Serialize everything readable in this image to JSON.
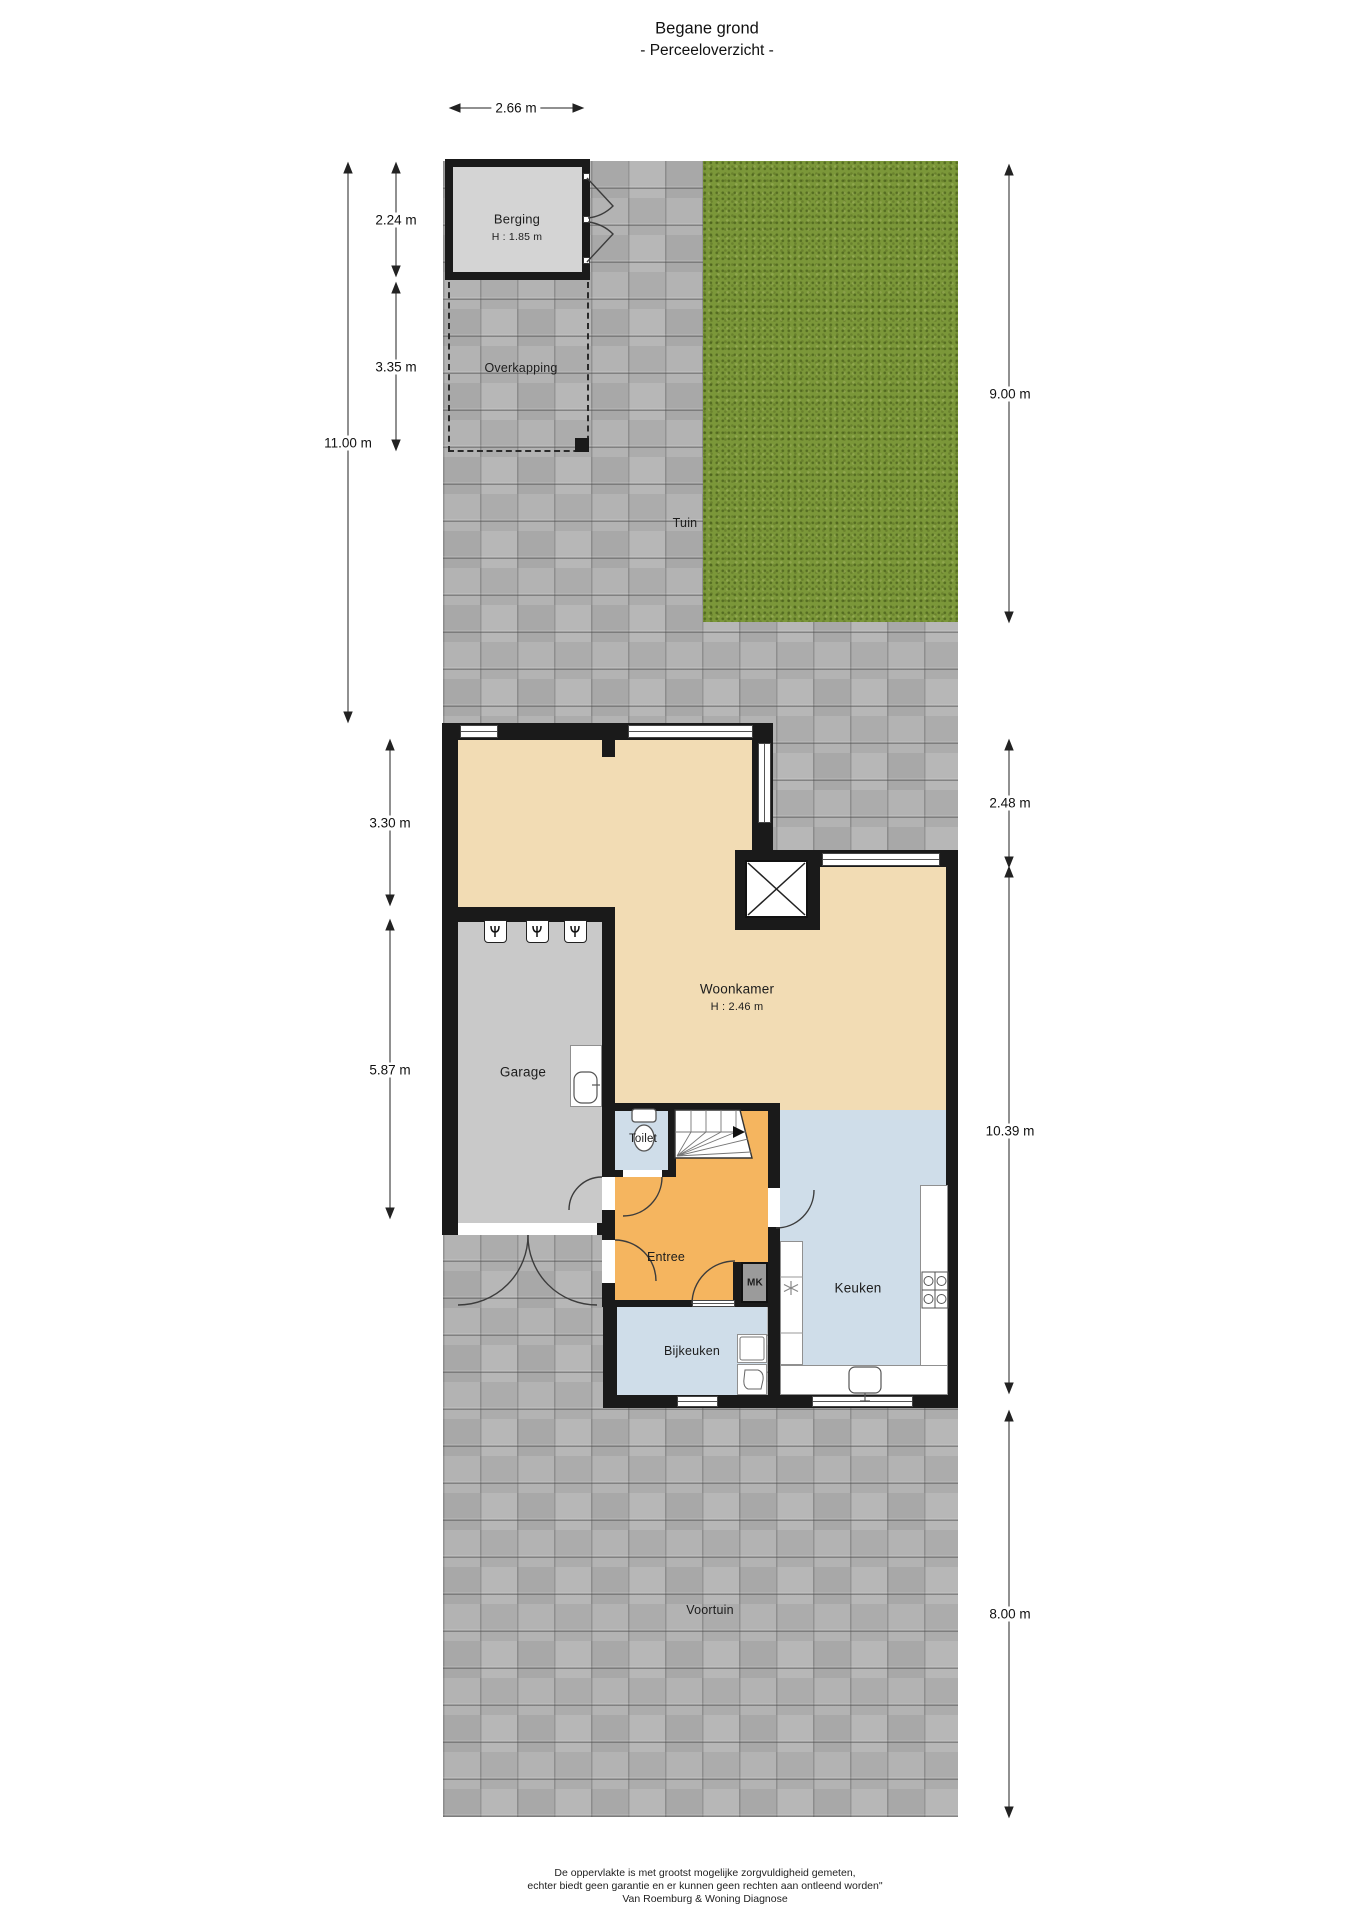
{
  "title": {
    "line1": "Begane grond",
    "line2": "- Perceeloverzicht -"
  },
  "rooms": {
    "berging": {
      "name": "Berging",
      "height": "H : 1.85 m"
    },
    "overkapping": {
      "name": "Overkapping"
    },
    "tuin": {
      "name": "Tuin"
    },
    "woonkamer": {
      "name": "Woonkamer",
      "height": "H : 2.46 m"
    },
    "garage": {
      "name": "Garage"
    },
    "toilet": {
      "name": "Toilet"
    },
    "entree": {
      "name": "Entree"
    },
    "keuken": {
      "name": "Keuken"
    },
    "bijkeuken": {
      "name": "Bijkeuken"
    },
    "mk": {
      "name": "MK"
    },
    "voortuin": {
      "name": "Voortuin"
    }
  },
  "dimensions": {
    "d266": "2.66 m",
    "d224": "2.24 m",
    "d335": "3.35 m",
    "d1100": "11.00 m",
    "d900": "9.00 m",
    "d330": "3.30 m",
    "d587": "5.87 m",
    "d248": "2.48 m",
    "d1039": "10.39 m",
    "d800": "8.00 m"
  },
  "footer": {
    "line1": "De oppervlakte is met grootst mogelijke zorgvuldigheid gemeten,",
    "line2": "echter biedt geen garantie en er kunnen geen rechten aan ontleend worden\"",
    "line3": "Van Roemburg & Woning Diagnose"
  },
  "colors": {
    "wall": "#1a1a1a",
    "woonkamer": "#f2dcb4",
    "entree": "#f5b55f",
    "wet": "#cfdde9",
    "garage": "#c9c9c9",
    "berging": "#d4d4d4",
    "tiles": "#b0b0b0",
    "grass": "#7b9739",
    "mk": "#9b9b9b"
  }
}
